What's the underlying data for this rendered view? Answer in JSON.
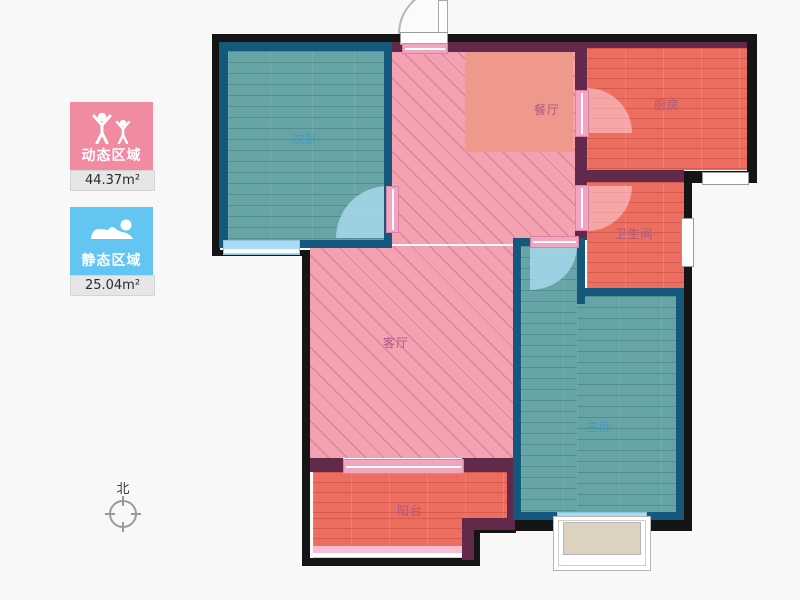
{
  "legend": {
    "dynamic": {
      "label": "动态区域",
      "value": "44.37m²",
      "icon": "people-active-icon",
      "color": "#f08ba2"
    },
    "static": {
      "label": "静态区域",
      "value": "25.04m²",
      "icon": "person-sleeping-icon",
      "color": "#63c5f1"
    }
  },
  "compass": {
    "north_label": "北"
  },
  "rooms": {
    "secondary_bedroom": {
      "label": "次卧",
      "zone": "static"
    },
    "dining": {
      "label": "餐厅",
      "zone": "dynamic"
    },
    "kitchen": {
      "label": "厨房",
      "zone": "dynamic"
    },
    "bathroom": {
      "label": "卫生间",
      "zone": "dynamic"
    },
    "living": {
      "label": "客厅",
      "zone": "dynamic"
    },
    "master_bedroom": {
      "label": "主卧",
      "zone": "static"
    },
    "balcony": {
      "label": "阳台",
      "zone": "dynamic"
    }
  },
  "colors": {
    "dynamic_zone": "#f08ba2",
    "static_zone": "#63c5f1",
    "pink_area": "#f4a1b1",
    "salmon_area": "#eb6e60",
    "teal_area": "#67a4a6",
    "wall_outer": "#151515",
    "wall_inner": "#63294a",
    "room_border": "#14587d"
  }
}
